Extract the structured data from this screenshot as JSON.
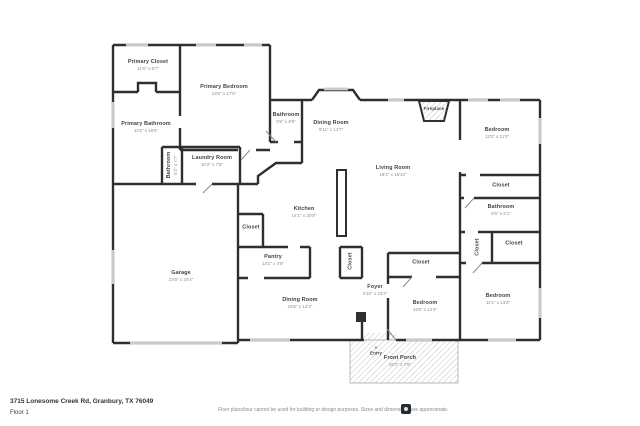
{
  "footer": {
    "address": "3715 Lonesome Creek Rd, Granbury, TX 76049",
    "floor_label": "Floor 1",
    "disclaimer": "Floor plans/tour cannot be used for building or design purposes. Sizes and dimensions are approximate."
  },
  "colors": {
    "wall": "#2f2f2f",
    "window": "#c9c9c9",
    "hatch": "#c2c2c2",
    "room_name": "#454545",
    "room_dims": "#8d8d8d"
  },
  "entry_marker_icon": "▲",
  "rooms": [
    {
      "name": "Primary Closet",
      "dims": "11'6\" x 8'7\"",
      "x": 148,
      "y": 65
    },
    {
      "name": "Primary Bedroom",
      "dims": "13'6\" x 17'5\"",
      "x": 224,
      "y": 90
    },
    {
      "name": "Primary Bathroom",
      "dims": "11'6\" x 16'6\"",
      "x": 146,
      "y": 127
    },
    {
      "name": "Bathroom",
      "dims": "5'2\" x 7'7\"",
      "x": 172,
      "y": 165,
      "rot": true
    },
    {
      "name": "Laundry Room",
      "dims": "10'2\" x 7'5\"",
      "x": 212,
      "y": 161
    },
    {
      "name": "Bathroom",
      "dims": "3'6\" x 8'9\"",
      "x": 286,
      "y": 118
    },
    {
      "name": "Dining Room",
      "dims": "9'11\" x 14'7\"",
      "x": 331,
      "y": 126
    },
    {
      "name": "Living Room",
      "dims": "18'4\" x 16'10\"",
      "x": 393,
      "y": 171
    },
    {
      "name": "Fireplace",
      "dims": "",
      "x": 434,
      "y": 109,
      "small": true
    },
    {
      "name": "Bedroom",
      "dims": "13'3\" x 11'0\"",
      "x": 497,
      "y": 133
    },
    {
      "name": "Closet",
      "dims": "",
      "x": 501,
      "y": 186
    },
    {
      "name": "Bathroom",
      "dims": "9'5\" x 6'1\"",
      "x": 501,
      "y": 210
    },
    {
      "name": "Closet",
      "dims": "",
      "x": 478,
      "y": 247,
      "rot": true
    },
    {
      "name": "Closet",
      "dims": "",
      "x": 514,
      "y": 244
    },
    {
      "name": "Kitchen",
      "dims": "14'1\" x 20'8\"",
      "x": 304,
      "y": 212
    },
    {
      "name": "Closet",
      "dims": "",
      "x": 251,
      "y": 228
    },
    {
      "name": "Pantry",
      "dims": "13'1\" x 4'6\"",
      "x": 273,
      "y": 260
    },
    {
      "name": "Closet",
      "dims": "",
      "x": 351,
      "y": 261,
      "rot": true
    },
    {
      "name": "Dining Room",
      "dims": "16'6\" x 12'4\"",
      "x": 300,
      "y": 303
    },
    {
      "name": "Foyer",
      "dims": "4'10\" x 15'2\"",
      "x": 375,
      "y": 290
    },
    {
      "name": "Closet",
      "dims": "",
      "x": 421,
      "y": 263
    },
    {
      "name": "Bedroom",
      "dims": "11'6\" x 12'4\"",
      "x": 425,
      "y": 306
    },
    {
      "name": "Bedroom",
      "dims": "11'1\" x 13'3\"",
      "x": 498,
      "y": 299
    },
    {
      "name": "Garage",
      "dims": "23'8\" x 24'4\"",
      "x": 181,
      "y": 276
    },
    {
      "name": "Entry",
      "dims": "",
      "x": 376,
      "y": 351,
      "small": true,
      "marker": true
    },
    {
      "name": "Front Porch",
      "dims": "26'1\" x 7'6\"",
      "x": 400,
      "y": 361
    }
  ]
}
